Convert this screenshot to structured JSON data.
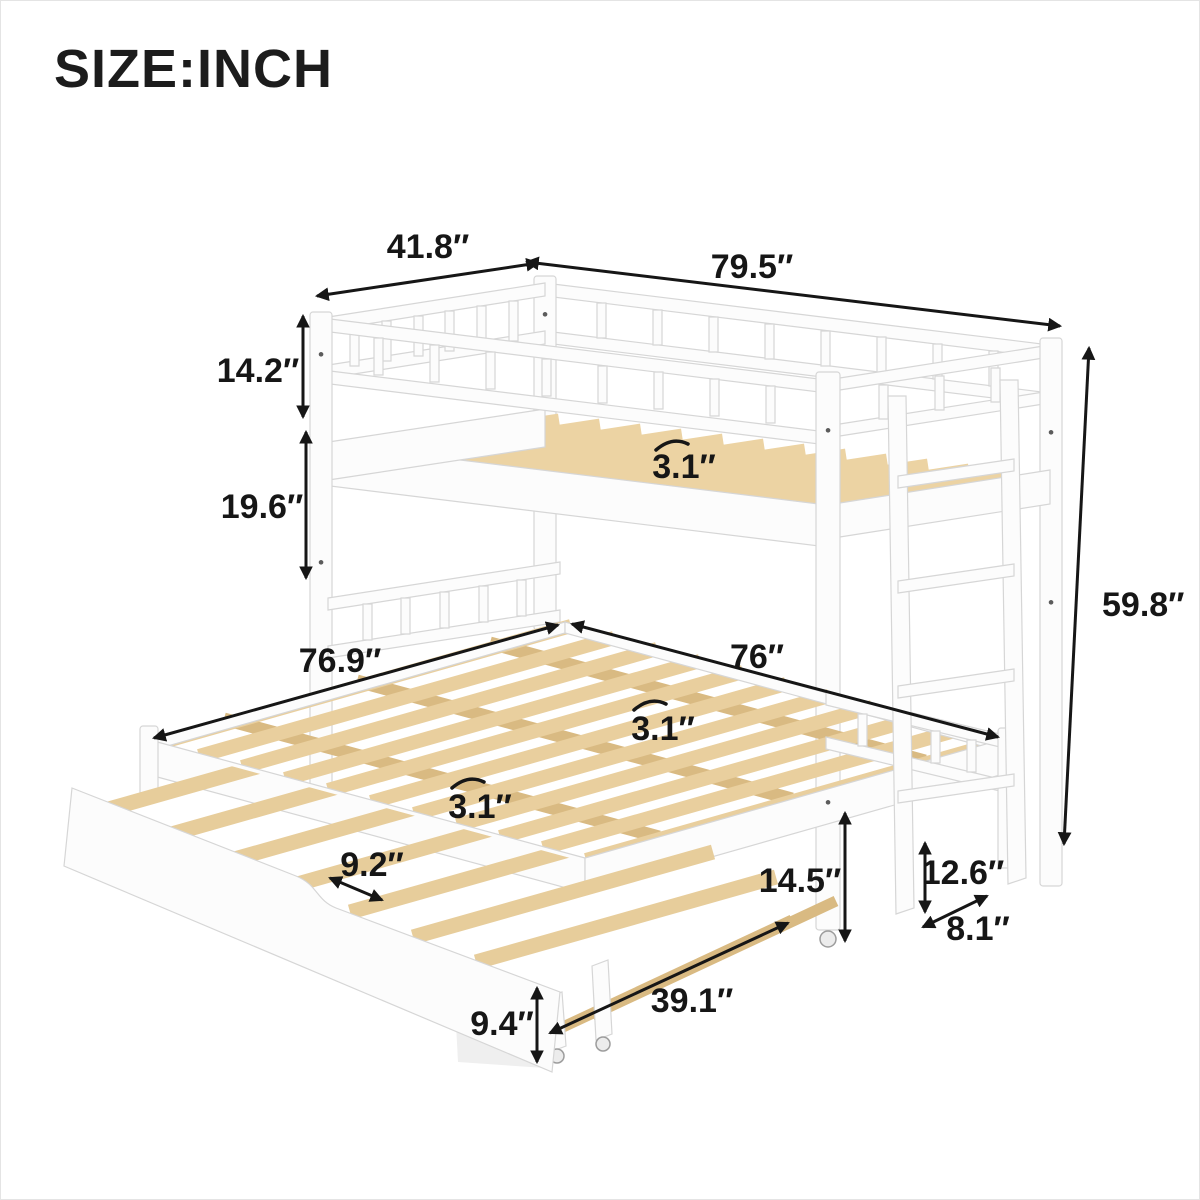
{
  "title": "SIZE:INCH",
  "diagram": {
    "product": "twin-over-pullout bunk bed with trundle, dimension drawing",
    "colors": {
      "frame_white": "#fcfcfc",
      "frame_outline": "#d6d6d6",
      "slat_wood": "#ecd3a3",
      "slat_wood_dark": "#d9ba82",
      "dimension_ink": "#161616",
      "background": "#ffffff"
    },
    "dims": {
      "upper_width": "41.8″",
      "upper_length": "79.5″",
      "guardrail_height": "14.2″",
      "bunk_clearance": "19.6″",
      "upper_slat_gap": "3.1″",
      "overall_height": "59.8″",
      "pullout_width": "76.9″",
      "pullout_length": "76″",
      "pullout_slat_gap": "3.1″",
      "pullout_slat_gap_front": "3.1″",
      "trundle_slat_gap": "9.2″",
      "underbed_clearance": "14.5″",
      "rear_leg_height": "12.6″",
      "leg_depth": "8.1″",
      "trundle_rail_length": "39.1″",
      "trundle_height": "9.4″"
    }
  }
}
